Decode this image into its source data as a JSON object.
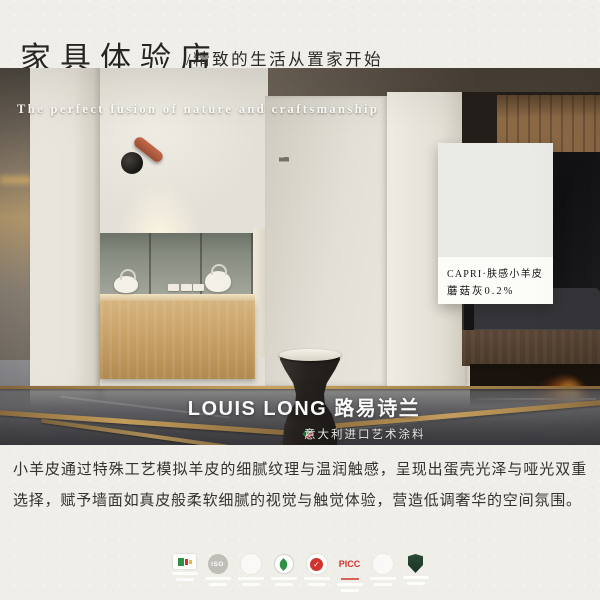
{
  "header": {
    "title": "家具体验店",
    "subtitle": "/精致的生活从置家开始"
  },
  "hero": {
    "tagline": "The perfect fusion of nature and craftsmanship",
    "swatch_card": {
      "product_line": "CAPRI·肤感小羊皮",
      "color_name": "蘑菇灰0.2%",
      "swatch_hex": "#e9ebe4"
    },
    "brand": {
      "logo": "LOUIS LONG 路易诗兰",
      "tagline": "意大利进口艺术涂料"
    }
  },
  "description": {
    "text": "小羊皮通过特殊工艺模拟羊皮的细腻纹理与温润触感，呈现出蛋壳光泽与哑光双重选择，赋予墙面如真皮般柔软细腻的视觉与触觉体验，营造低调奢华的空间氛围。"
  },
  "certifications": {
    "badges": [
      {
        "name": "emission-label"
      },
      {
        "name": "iso",
        "label": "ISO"
      },
      {
        "name": "cert-seal-1"
      },
      {
        "name": "eco-leaf"
      },
      {
        "name": "quality-check"
      },
      {
        "name": "picc",
        "label": "PICC"
      },
      {
        "name": "cert-seal-2"
      },
      {
        "name": "green-shield"
      }
    ]
  },
  "colors": {
    "paper": "#efeee8",
    "terracotta": "#b65f3d",
    "counter_wood": "#c9a266",
    "flame": "#ff8c1e",
    "brand_text": "#ffffff"
  }
}
